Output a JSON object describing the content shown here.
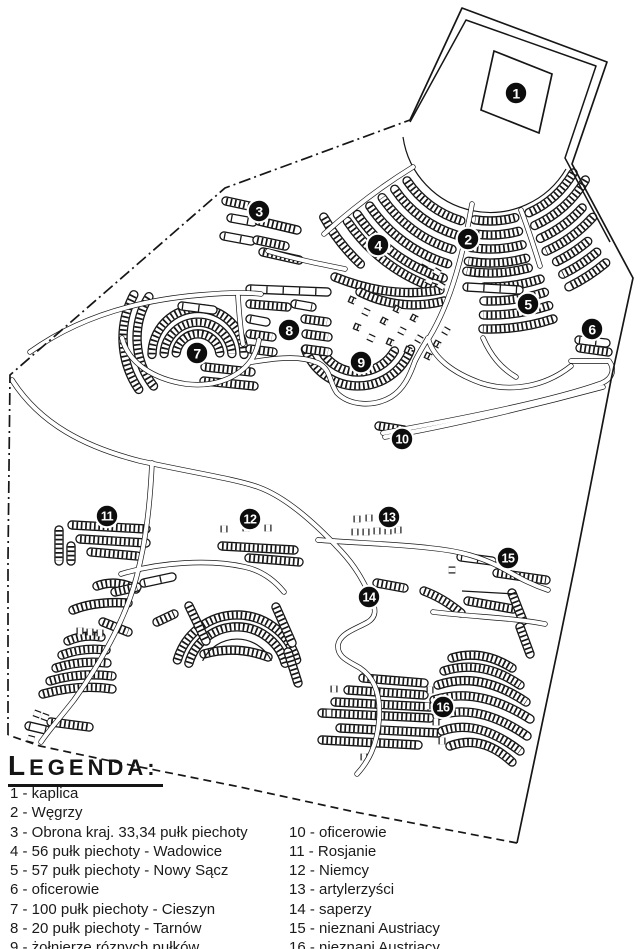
{
  "colors": {
    "ink": "#161616",
    "paper": "#ffffff"
  },
  "legend": {
    "title": "LEGENDA:",
    "left": [
      {
        "num": "1",
        "label": "kaplica"
      },
      {
        "num": "2",
        "label": "Węgrzy"
      },
      {
        "num": "3",
        "label": "Obrona kraj. 33,34 pułk piechoty"
      },
      {
        "num": "4",
        "label": "56 pułk piechoty - Wadowice"
      },
      {
        "num": "5",
        "label": "57 pułk piechoty - Nowy Sącz"
      },
      {
        "num": "6",
        "label": "oficerowie"
      },
      {
        "num": "7",
        "label": "100 pułk piechoty - Cieszyn"
      },
      {
        "num": "8",
        "label": "20 pułk piechoty - Tarnów"
      },
      {
        "num": "9",
        "label": "żołnierze róznych pułków"
      }
    ],
    "right": [
      {
        "num": "10",
        "label": "oficerowie"
      },
      {
        "num": "11",
        "label": "Rosjanie"
      },
      {
        "num": "12",
        "label": "Niemcy"
      },
      {
        "num": "13",
        "label": "artylerzyści"
      },
      {
        "num": "14",
        "label": "saperzy"
      },
      {
        "num": "15",
        "label": "nieznani Austriacy"
      },
      {
        "num": "16",
        "label": "nieznani Austriacy"
      }
    ]
  },
  "map": {
    "markers": [
      {
        "num": "1",
        "x": 516,
        "y": 93
      },
      {
        "num": "2",
        "x": 468,
        "y": 239
      },
      {
        "num": "3",
        "x": 259,
        "y": 211
      },
      {
        "num": "4",
        "x": 378,
        "y": 245
      },
      {
        "num": "5",
        "x": 528,
        "y": 304
      },
      {
        "num": "6",
        "x": 592,
        "y": 329
      },
      {
        "num": "7",
        "x": 197,
        "y": 353
      },
      {
        "num": "8",
        "x": 289,
        "y": 330
      },
      {
        "num": "9",
        "x": 361,
        "y": 362
      },
      {
        "num": "10",
        "x": 402,
        "y": 439
      },
      {
        "num": "11",
        "x": 107,
        "y": 516
      },
      {
        "num": "12",
        "x": 250,
        "y": 519
      },
      {
        "num": "13",
        "x": 389,
        "y": 517
      },
      {
        "num": "14",
        "x": 369,
        "y": 597
      },
      {
        "num": "15",
        "x": 508,
        "y": 558
      },
      {
        "num": "16",
        "x": 443,
        "y": 707
      }
    ]
  }
}
